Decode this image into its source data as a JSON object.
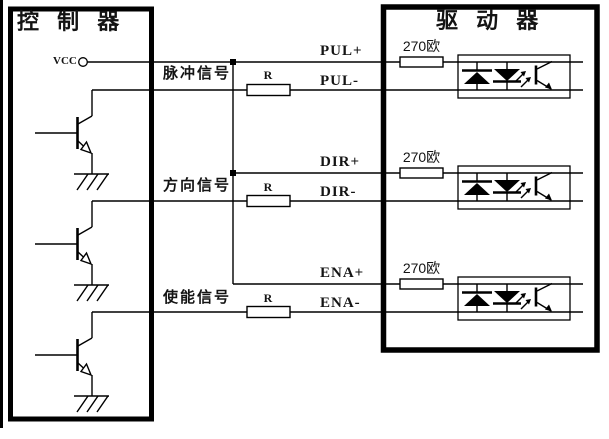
{
  "diagram": {
    "background_color": "#ffffff",
    "line_color": "#000000",
    "controller": {
      "title": "控 制 器",
      "vcc_label": "VCC",
      "symbols": [
        "vcc-circle-terminal",
        "npn-transistor",
        "earth-ground"
      ]
    },
    "driver": {
      "title": "驱 动 器",
      "symbols": [
        "resistor-box",
        "optocoupler"
      ]
    },
    "channels": [
      {
        "signal_label": "脉冲信号",
        "controller_resistor_label": "R",
        "plus_pin": "PUL+",
        "minus_pin": "PUL-",
        "driver_resistor_label": "270欧"
      },
      {
        "signal_label": "方向信号",
        "controller_resistor_label": "R",
        "plus_pin": "DIR+",
        "minus_pin": "DIR-",
        "driver_resistor_label": "270欧"
      },
      {
        "signal_label": "使能信号",
        "controller_resistor_label": "R",
        "plus_pin": "ENA+",
        "minus_pin": "ENA-",
        "driver_resistor_label": "270欧"
      }
    ]
  }
}
